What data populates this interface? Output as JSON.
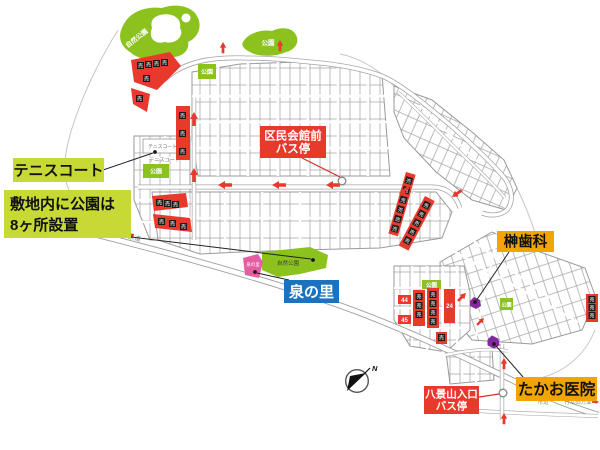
{
  "colors": {
    "label_yellow_green": "#c6d935",
    "label_red": "#e8392d",
    "label_orange": "#f0a500",
    "label_blue": "#1b72be",
    "park_green": "#8cc21e",
    "izumi_pink": "#e75da1",
    "building_purple": "#8428a0",
    "sale_red": "#e8392d",
    "sale_black": "#1a1a1a"
  },
  "callouts": {
    "tennis_court": {
      "label": "テニスコート"
    },
    "parks_note": {
      "line1": "敷地内に公園は",
      "line2": "8ヶ所設置"
    },
    "kumin_kaikan_bus": {
      "line1": "区民会館前",
      "line2": "バス停"
    },
    "sakaki_dental": {
      "label": "榊歯科"
    },
    "izumi_no_sato": {
      "label": "泉の里"
    },
    "takao_clinic": {
      "label": "たかお医院"
    },
    "hakkeiyama_bus": {
      "line1": "八景山入口",
      "line2": "バス停"
    }
  },
  "map_labels": {
    "nature_park_nw": "自然公園",
    "park_ne": "公園",
    "tennis_court_box": "テニスコート",
    "tennis_court_text": "テニスコート",
    "park_box_west": "公園",
    "park_box_grid": "公園",
    "park_box_se": "公園",
    "park_box_east": "公園",
    "nature_park_center": "自然公園",
    "izumi_area": "泉の里",
    "road_kendo": "県道",
    "road_shido": "市道",
    "direction_note": "行幸田方面",
    "lot_24": "24",
    "lot_44": "44",
    "lot_45": "45",
    "sale": "売"
  },
  "compass": {
    "north": "N"
  }
}
